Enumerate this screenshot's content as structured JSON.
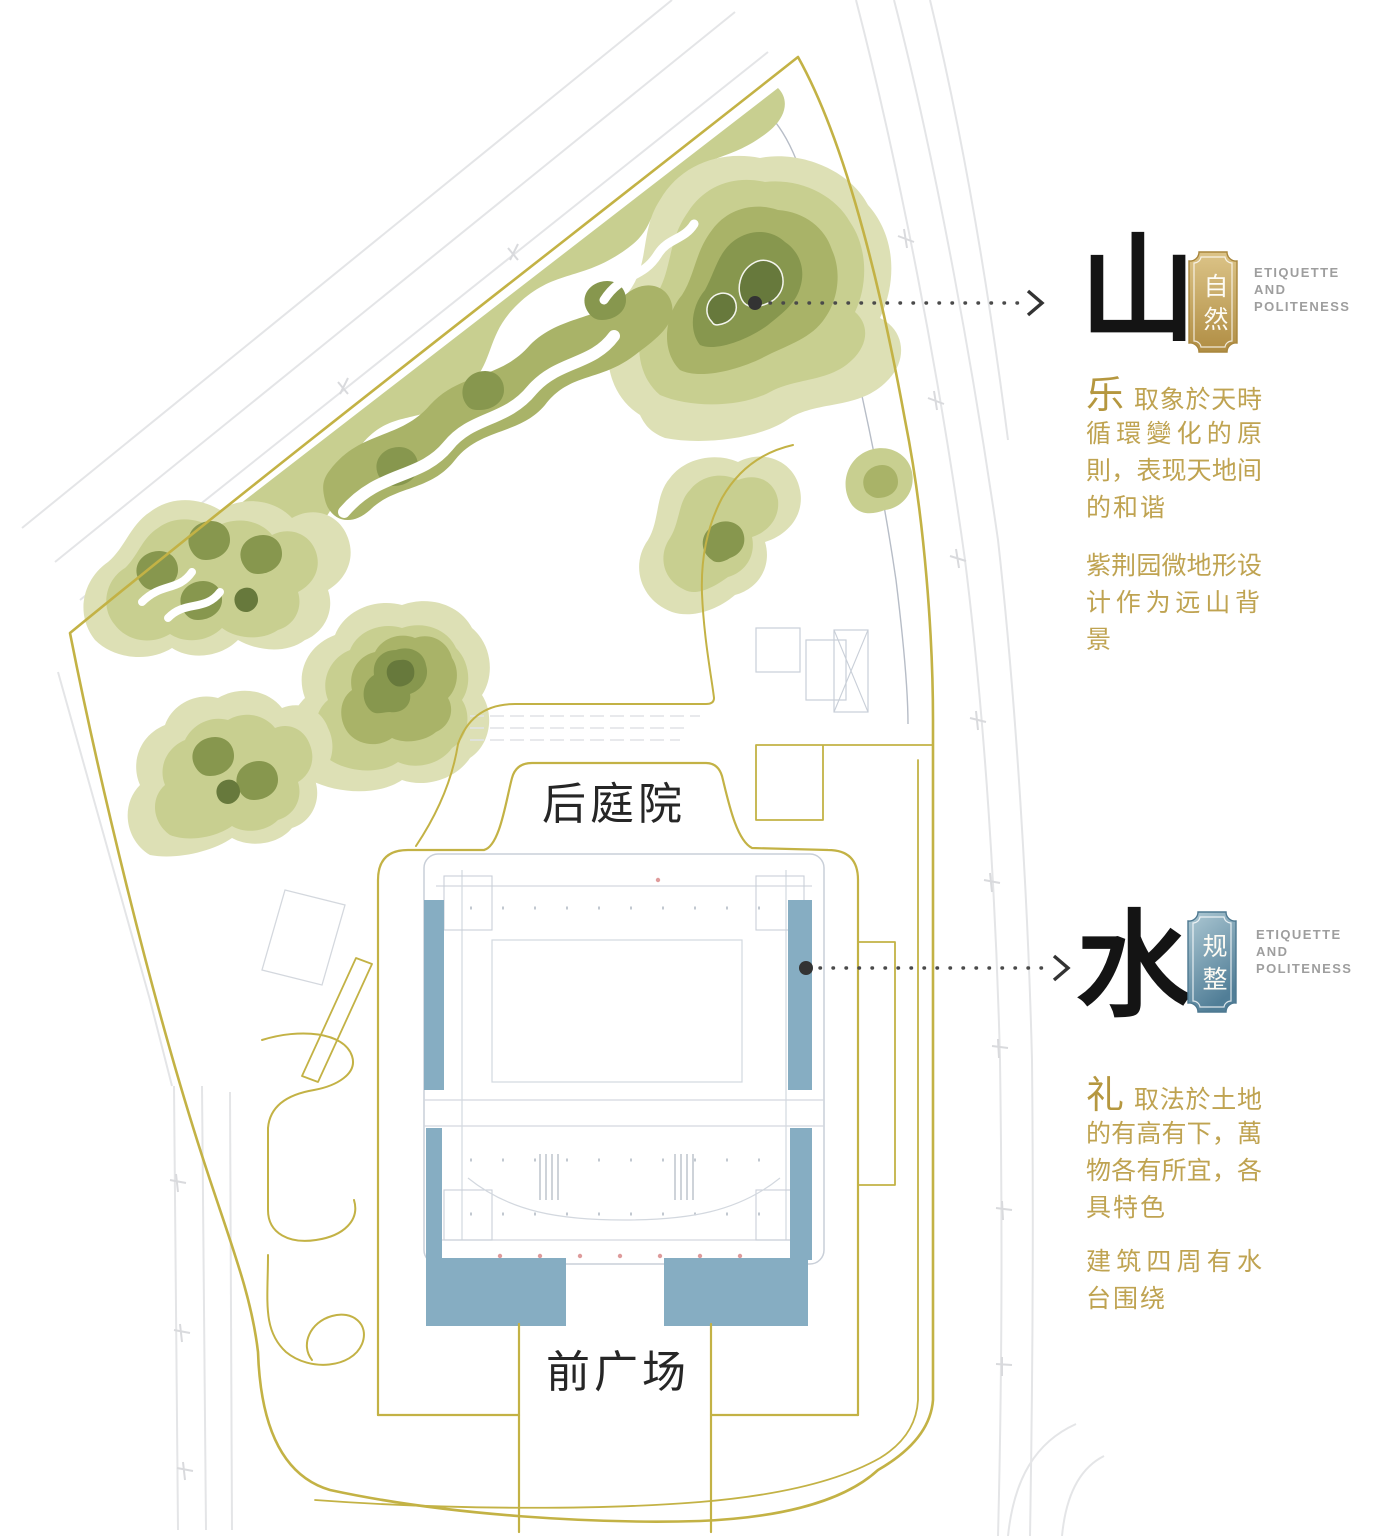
{
  "plan": {
    "labels": {
      "back_courtyard": "后庭院",
      "front_plaza": "前广场"
    }
  },
  "annotations": {
    "mountain": {
      "glyph": "山",
      "seal": "自然",
      "etiquette": "ETIQUETTE\nAND\nPOLITENESS",
      "lead": "乐",
      "lead_rest": "取象於天時",
      "para1_lines": [
        "循環變化的原",
        "則，表现天地间",
        "的和谐"
      ],
      "para2_lines": [
        "紫荆园微地形设",
        "计作为远山背景"
      ]
    },
    "water": {
      "glyph": "水",
      "seal": "规整",
      "etiquette": "ETIQUETTE\nAND\nPOLITENESS",
      "lead": "礼",
      "lead_rest": "取法於土地",
      "para1_lines": [
        "的有高有下，萬",
        "物各有所宜，各",
        "具特色"
      ],
      "para2_lines": [
        "建筑四周有水",
        "台围绕"
      ]
    }
  },
  "colors": {
    "boundary_gold": "#c3b245",
    "annotation_gold_text": "#bfa351",
    "seal_gold_top": "#dcc488",
    "seal_gold_bottom": "#b08d43",
    "seal_blue_top": "#aec9d4",
    "seal_blue_bottom": "#517e97",
    "water_blue": "#86adc2",
    "hill_l1": "#dde0b5",
    "hill_l2": "#c8cf90",
    "hill_l3": "#a9b368",
    "hill_l4": "#87974e",
    "hill_l5": "#67793c",
    "label_black": "#262626",
    "etiquette_gray": "#9e9e9e"
  }
}
